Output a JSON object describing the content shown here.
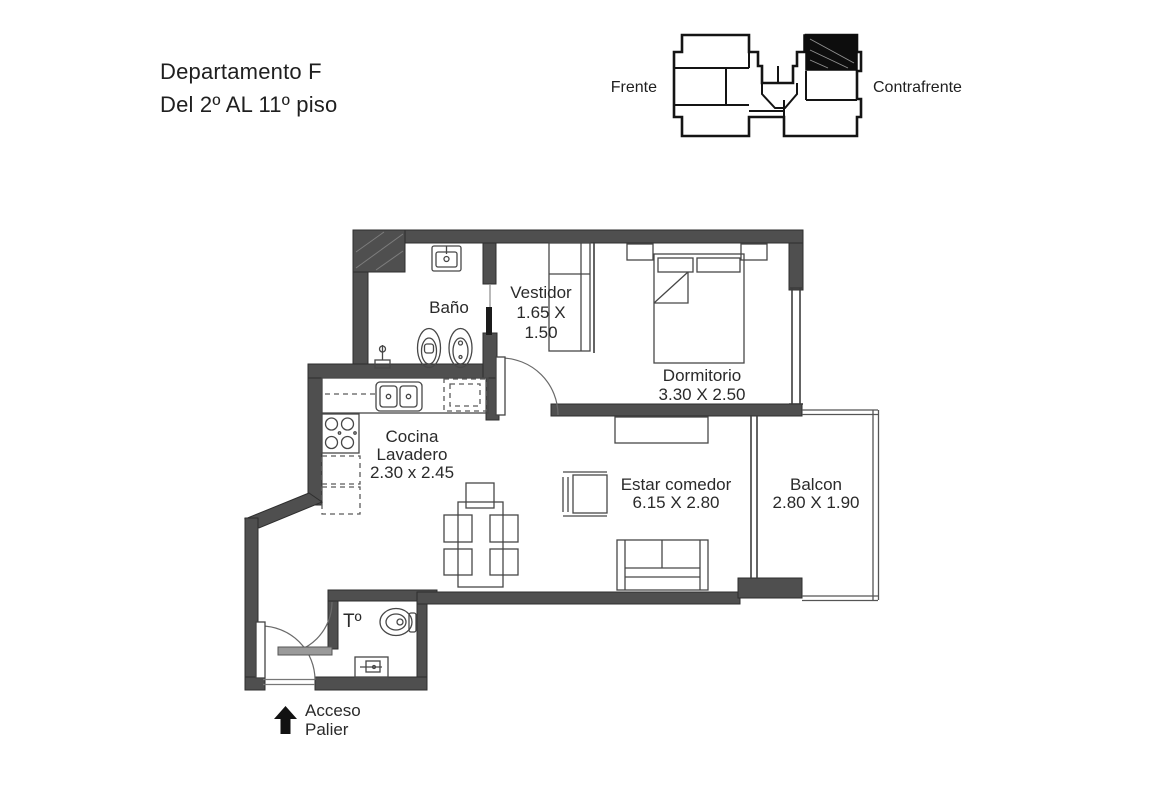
{
  "header": {
    "title_line1": "Departamento F",
    "title_line2": "Del 2º AL 11º piso"
  },
  "keyplan": {
    "left_label": "Frente",
    "right_label": "Contrafrente"
  },
  "rooms": {
    "bano": {
      "name": "Baño"
    },
    "vestidor": {
      "name": "Vestidor",
      "dim_line1": "1.65 X",
      "dim_line2": "1.50"
    },
    "dormitorio": {
      "name": "Dormitorio",
      "dims": "3.30 X 2.50"
    },
    "cocina": {
      "name_line1": "Cocina",
      "name_line2": "Lavadero",
      "dims": "2.30 x 2.45"
    },
    "estar": {
      "name": "Estar comedor",
      "dims": "6.15 X 2.80"
    },
    "balcon": {
      "name": "Balcon",
      "dims": "2.80 X 1.90"
    },
    "toilette": {
      "name": "Tº"
    }
  },
  "access": {
    "line1": "Acceso",
    "line2": "Palier"
  },
  "colors": {
    "wall": "#4f4f4f",
    "wall_edge": "#2e2e2e",
    "thin_line": "#3d3d3d",
    "furniture_line": "#474747",
    "highlight_unit": "#0d0d0d",
    "text": "#262626",
    "background": "#ffffff"
  }
}
